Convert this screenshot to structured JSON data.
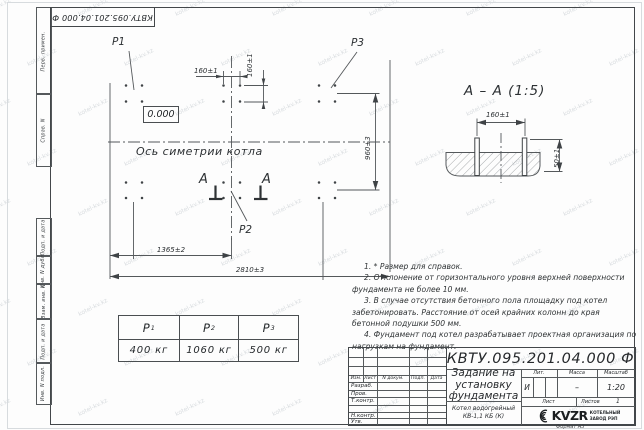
{
  "watermark": {
    "text": "kotel-kv.kz"
  },
  "frame": {
    "stamp_top": "КВТУ.095.201.04.000 Ф",
    "format_note": "Формат А3",
    "sidebar_items": [
      "Перв. примен.",
      "Справ. N",
      "Подп. и дата",
      "Инв. N дубл.",
      "Взам. инв. N",
      "Подп. и дата",
      "Инв. N подл."
    ]
  },
  "plan": {
    "p1": "P1",
    "p2": "P2",
    "p3": "P3",
    "elevation": "0.000",
    "axis_label": "Ось симетрии котла",
    "section_letter_left": "А",
    "section_letter_right": "А",
    "dim_bolt_h": "160±1",
    "dim_bolt_v": "160±1",
    "dim_height": "960±3",
    "dim_left": "1365±2",
    "dim_total": "2810±3"
  },
  "section": {
    "title": "А – А (1:5)",
    "dim_spacing": "160±1",
    "dim_protrusion": "50±1"
  },
  "notes": [
    "1. * Размер для справок.",
    "2. Отклонение от горизонтального уровня верхней поверхности фундамента не более 10 мм.",
    "3. В случае отсутствия бетонного пола площадку под котел забетонировать. Расстояние от осей крайних колонн до края бетонной подушки 500 мм.",
    "4. Фундамент под котел разрабатывает проектная организация по нагрузкам на фундамент."
  ],
  "loads": {
    "columns": [
      {
        "name": "P",
        "sub": "1",
        "value": "400 кг"
      },
      {
        "name": "P",
        "sub": "2",
        "value": "1060 кг"
      },
      {
        "name": "P",
        "sub": "3",
        "value": "500 кг"
      }
    ]
  },
  "title_block": {
    "doc_number": "КВТУ.095.201.04.000 Ф",
    "title": "Задание на установку фундамента",
    "subject": "Котел водогрейный КВ-1,1 КБ (К)",
    "rev_header": [
      "Изм.",
      "Лист",
      "N докум.",
      "Подп.",
      "Дата"
    ],
    "sign_rows": [
      "Разраб.",
      "Пров.",
      "Т.контр.",
      "Н.контр.",
      "Утв."
    ],
    "lit_label": "Лит.",
    "mass_label": "Масса",
    "scale_label": "Масштаб",
    "lit_value": "И",
    "mass_value": "–",
    "scale_value": "1:20",
    "sheet_label": "Лист",
    "sheets_label": "Листов",
    "sheets_value": "1",
    "logo_text": "KVZR",
    "logo_caption_1": "КОТЕЛЬНЫЙ",
    "logo_caption_2": "ЗАВОД РЭП"
  }
}
